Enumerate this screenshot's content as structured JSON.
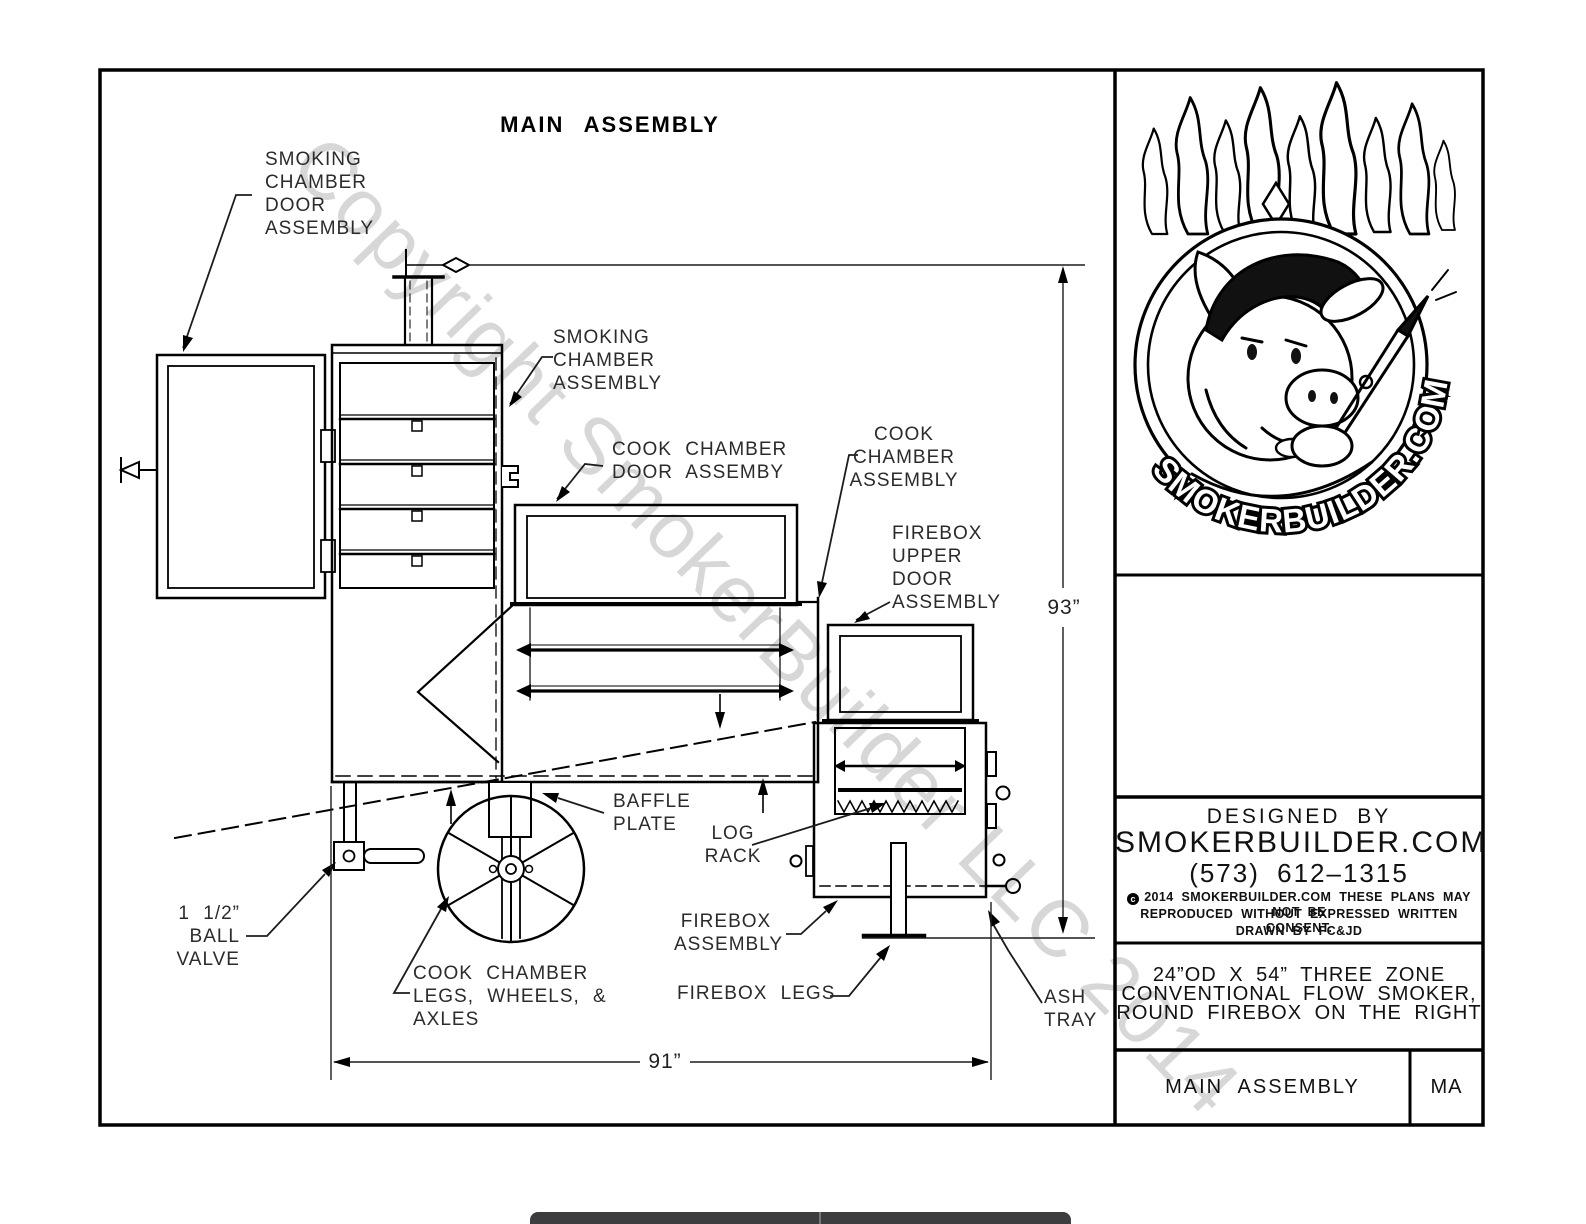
{
  "title": "MAIN ASSEMBLY",
  "watermark": "Copyright SmokerBuilder LLC 2014",
  "dimensions": {
    "height": "93”",
    "width": "91”"
  },
  "labels": {
    "smoking_chamber_door": [
      "SMOKING",
      "CHAMBER",
      "DOOR",
      "ASSEMBLY"
    ],
    "smoking_chamber": [
      "SMOKING",
      "CHAMBER",
      "ASSEMBLY"
    ],
    "cook_chamber_door": [
      "COOK CHAMBER",
      "DOOR ASSEMBY"
    ],
    "cook_chamber": [
      "COOK",
      "CHAMBER",
      "ASSEMBLY"
    ],
    "firebox_upper_door": [
      "FIREBOX",
      "UPPER",
      "DOOR",
      "ASSEMBLY"
    ],
    "baffle_plate": [
      "BAFFLE",
      "PLATE"
    ],
    "log_rack": [
      "LOG",
      "RACK"
    ],
    "firebox": [
      "FIREBOX",
      "ASSEMBLY"
    ],
    "firebox_legs": "FIREBOX LEGS",
    "ash_tray": [
      "ASH",
      "TRAY"
    ],
    "ball_valve": [
      "1 1/2”",
      "BALL",
      "VALVE"
    ],
    "cook_chamber_legs": [
      "COOK CHAMBER",
      "LEGS, WHEELS, &",
      "AXLES"
    ]
  },
  "title_block": {
    "designed_by": "DESIGNED BY",
    "company": "SMOKERBUILDER.COM",
    "phone": "(573) 612–1315",
    "copyright_line1": "2014 SMOKERBUILDER.COM THESE PLANS MAY NOT BE",
    "copyright_line2": "REPRODUCED WITHOUT EXPRESSED WRITTEN CONSENT.",
    "drawn_by": "DRAWN BY FC&JD",
    "description_line1": "24”OD X 54” THREE ZONE",
    "description_line2": "CONVENTIONAL FLOW SMOKER,",
    "description_line3": "ROUND FIREBOX ON THE RIGHT",
    "sheet_title": "MAIN ASSEMBLY",
    "sheet_code": "MA"
  },
  "logo": {
    "brand": "SMOKERBUILDER.COM"
  }
}
